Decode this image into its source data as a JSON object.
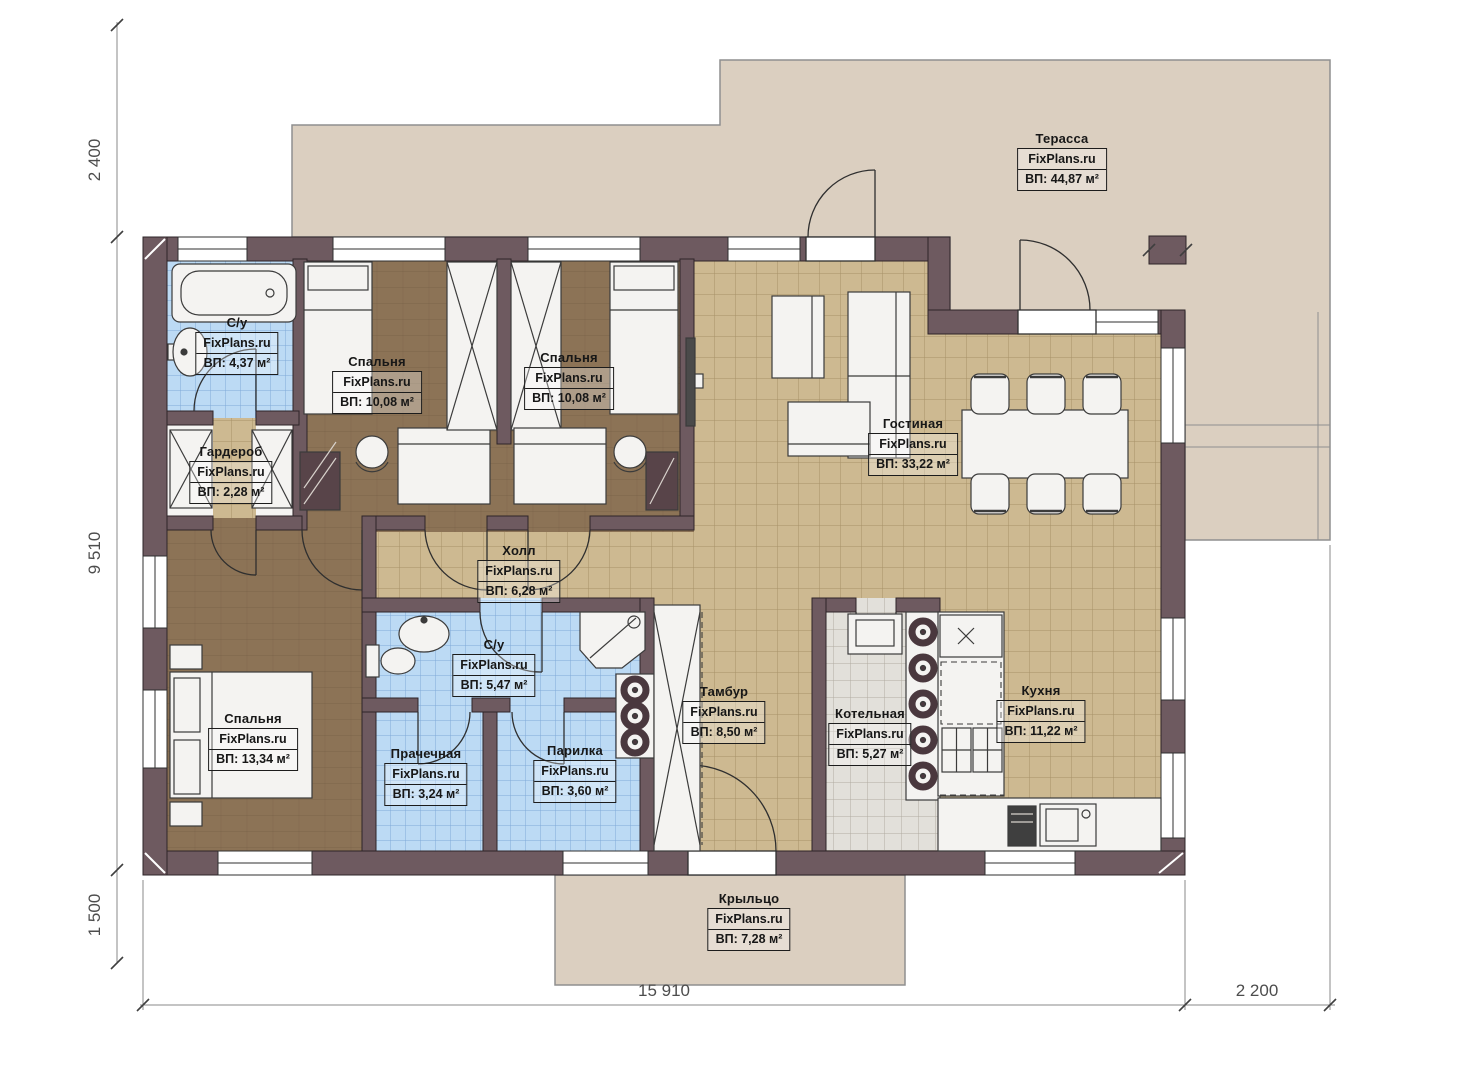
{
  "brand": "FixPlans.ru",
  "rooms": [
    {
      "name": "Терасса",
      "area": "ВП: 44,87 м²"
    },
    {
      "name": "С/у",
      "area": "ВП: 4,37 м²"
    },
    {
      "name": "Спальня",
      "area": "ВП: 10,08 м²"
    },
    {
      "name": "Спальня",
      "area": "ВП: 10,08 м²"
    },
    {
      "name": "Гардероб",
      "area": "ВП: 2,28 м²"
    },
    {
      "name": "Гостиная",
      "area": "ВП: 33,22 м²"
    },
    {
      "name": "Холл",
      "area": "ВП: 6,28 м²"
    },
    {
      "name": "С/у",
      "area": "ВП: 5,47 м²"
    },
    {
      "name": "Тамбур",
      "area": "ВП: 8,50 м²"
    },
    {
      "name": "Котельная",
      "area": "ВП: 5,27 м²"
    },
    {
      "name": "Кухня",
      "area": "ВП: 11,22 м²"
    },
    {
      "name": "Спальня",
      "area": "ВП: 13,34 м²"
    },
    {
      "name": "Прачечная",
      "area": "ВП: 3,24 м²"
    },
    {
      "name": "Парилка",
      "area": "ВП: 3,60 м²"
    },
    {
      "name": "Крыльцо",
      "area": "ВП: 7,28 м²"
    }
  ],
  "dimensions": {
    "terrace_depth": "2 400",
    "house_depth": "9 510",
    "porch_depth": "1 500",
    "house_width": "15 910",
    "terrace_width": "2 200"
  },
  "colors": {
    "wall": "#6e5a60",
    "floor_tile_tan": "#cdb991",
    "floor_wood": "#8c7356",
    "tile_blue": "#bcdaf4",
    "tile_gray": "#e2e0da",
    "terrace": "#dbcfc0"
  }
}
